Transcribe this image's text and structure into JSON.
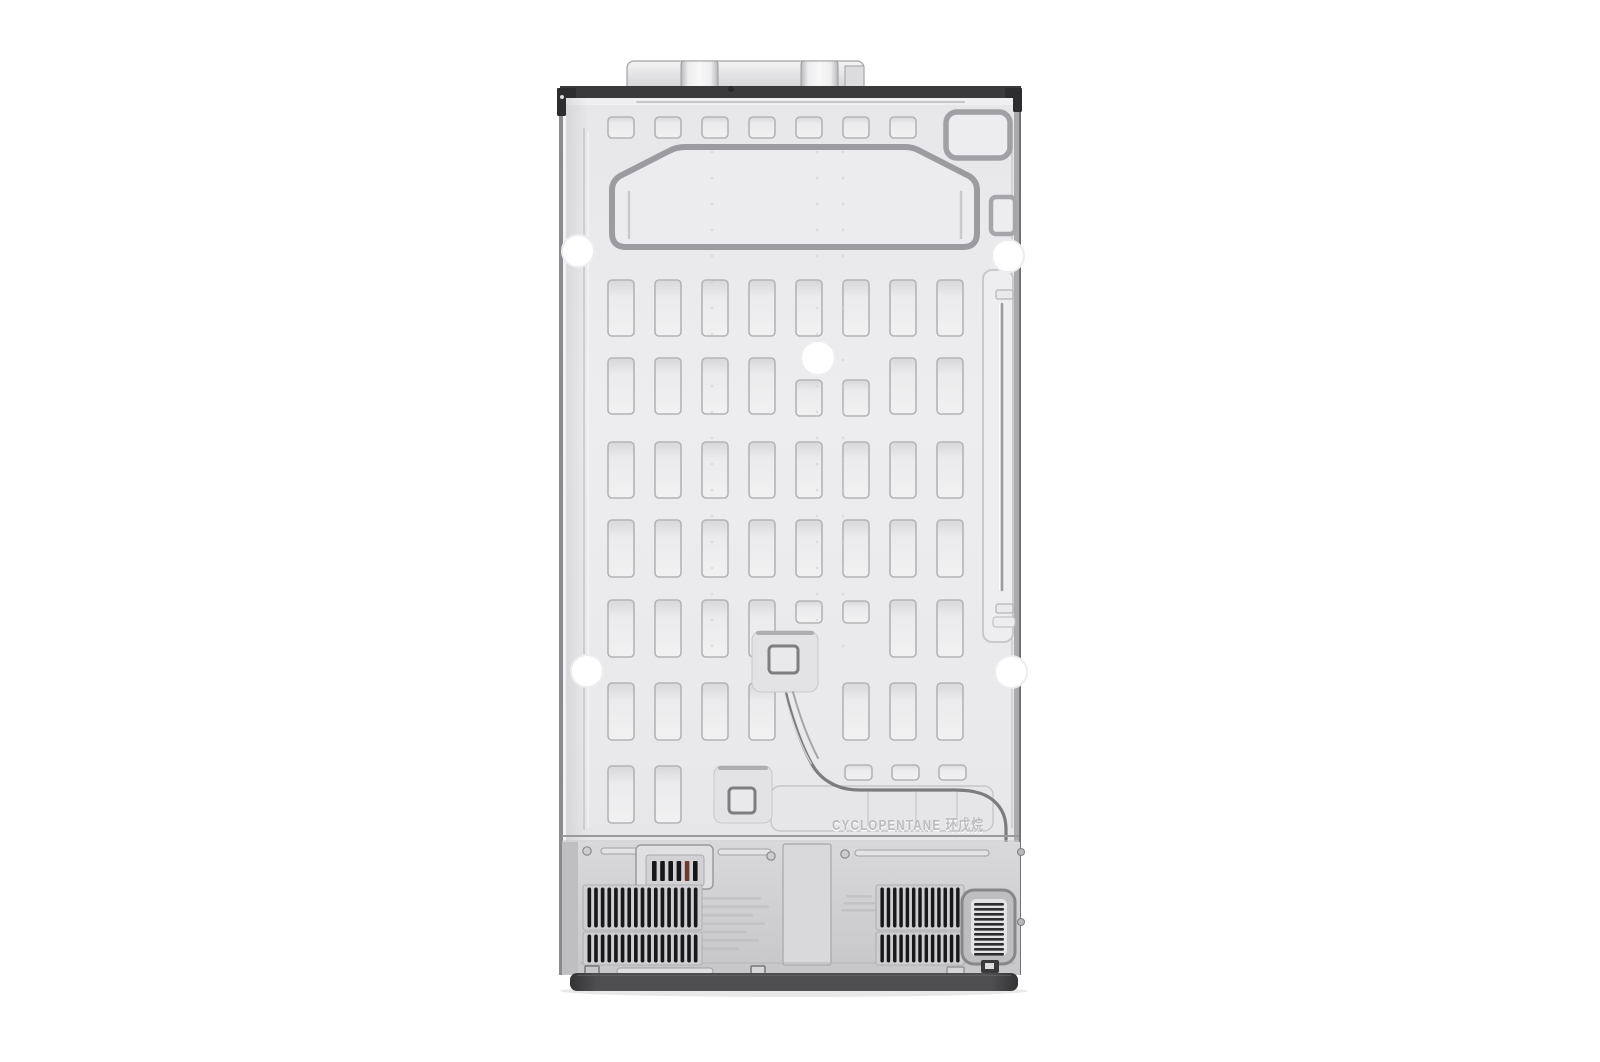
{
  "scene": {
    "description": "Rear view product photo of a side-by-side refrigerator back panel, centered on a plain white background",
    "background_color": "#ffffff"
  },
  "panel": {
    "embossed_label": "CYCLOPENTANE 环戊烷",
    "material_colors": {
      "panel": "#e9e9eb",
      "panel_light": "#f1f1f2",
      "slot_stroke": "#b4b4b7",
      "emboss_outline": "#9c9ca0",
      "groove": "#c8c8cb",
      "top_rail": "#3a3a3c",
      "bracket": "#2d2d2f",
      "tube": "#7c7c80",
      "compressor_section": "#cfcfd1",
      "grille_slat": "#18181a",
      "vent_slat": "#2c2c2e",
      "cord_bar": "#17171a",
      "cord_bar_accent": "#6e3b31",
      "stamp": "#b9b9bc",
      "base": "#4b4b4d",
      "hole": "#ffffff",
      "dot": "#cdcdd0"
    },
    "pattern": {
      "slot_columns": 8,
      "tall_slot_rows": 7,
      "top_short_slots": 7,
      "bottom_wide_slots": 3
    },
    "mount_holes": 5,
    "grilles": {
      "left_slats": 17,
      "right_slats": 13,
      "side_vent_slats": 11,
      "cord_block_bars": 6
    }
  }
}
